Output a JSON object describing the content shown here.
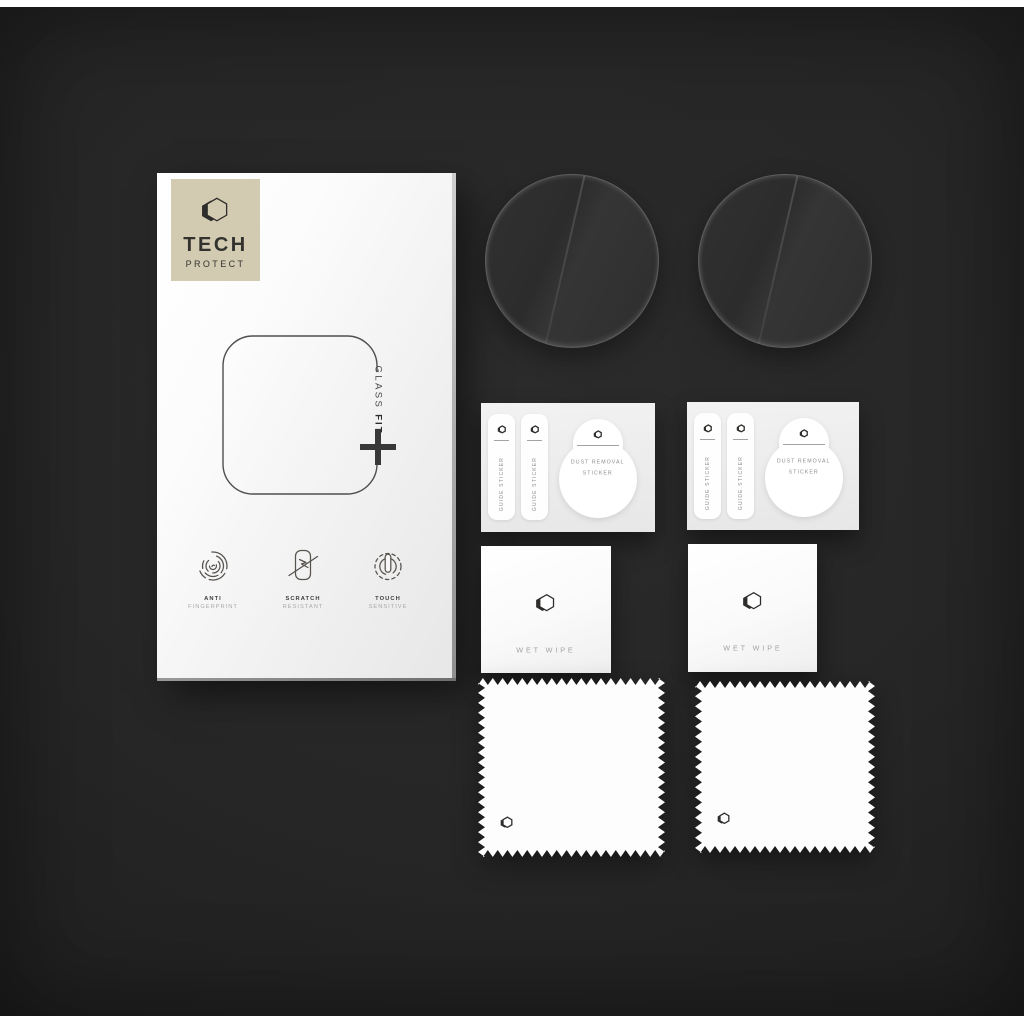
{
  "photo": {
    "alt": "Tech Protect Glass Fit watch screen protector kit on dark background"
  },
  "box": {
    "brand_top": "TECH",
    "brand_bottom": "PROTECT",
    "glass_label_regular": "GLASS ",
    "glass_label_bold": "FIT",
    "features": [
      {
        "title": "ANTI",
        "subtitle": "FINGERPRINT"
      },
      {
        "title": "SCRATCH",
        "subtitle": "RESISTANT"
      },
      {
        "title": "TOUCH",
        "subtitle": "SENSITIVE"
      }
    ]
  },
  "sheets": [
    {
      "guide_sticker_1": "GUIDE STICKER",
      "guide_sticker_2": "GUIDE STICKER",
      "dust_removal_line_1": "DUST REMOVAL",
      "dust_removal_line_2": "STICKER"
    },
    {
      "guide_sticker_1": "GUIDE STICKER",
      "guide_sticker_2": "GUIDE STICKER",
      "dust_removal_line_1": "DUST REMOVAL",
      "dust_removal_line_2": "STICKER"
    }
  ],
  "wipes": [
    {
      "label": "WET WIPE"
    },
    {
      "label": "WET WIPE"
    }
  ],
  "colors": {
    "background": "#262626",
    "letterbox": "#ffffff",
    "brand_tile": "#d3cbb1",
    "box_face": "#f7f7f7",
    "ink": "#2f2f2f",
    "muted_text": "#8e8e8e"
  }
}
